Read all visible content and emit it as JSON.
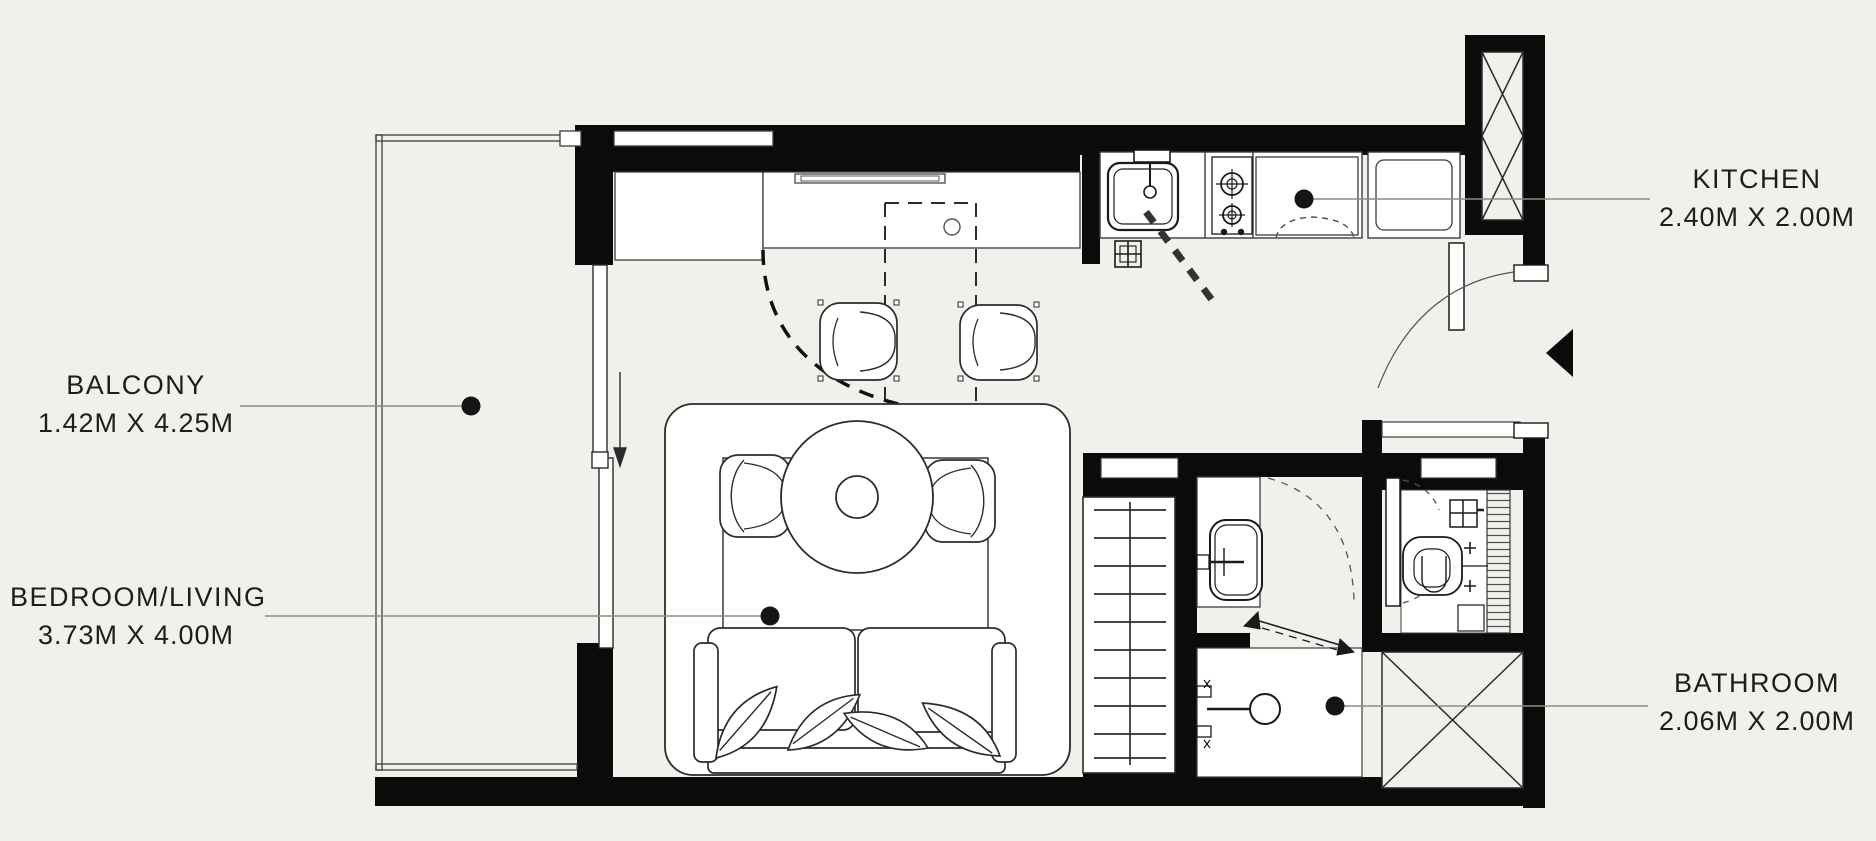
{
  "plan": {
    "title": "Studio apartment floor plan",
    "rooms": {
      "balcony": {
        "label": "BALCONY",
        "dimensions": "1.42M X 4.25M"
      },
      "bedroom_living": {
        "label": "BEDROOM/LIVING",
        "dimensions": "3.73M X 4.00M"
      },
      "kitchen": {
        "label": "KITCHEN",
        "dimensions": "2.40M X 2.00M"
      },
      "bathroom": {
        "label": "BATHROOM",
        "dimensions": "2.06M X 2.00M"
      }
    },
    "fixtures": [
      "kitchen-sink",
      "gas-hob",
      "oven-cabinet",
      "refrigerator",
      "range-hood",
      "floor-drain",
      "breakfast-counter",
      "bar-stool",
      "dining-table",
      "dining-chair",
      "rug",
      "sofa",
      "pillow",
      "wardrobe",
      "sliding-door",
      "entry-door",
      "entry-arrow",
      "vanity-sink",
      "shower",
      "toilet",
      "duct-shaft",
      "window"
    ],
    "colors": {
      "background": "#f2f0eb",
      "wall": "#0b0b0b",
      "furniture_line": "#2b2b2b",
      "leader_line": "#8f8b85",
      "fixture_fill": "#ffffff"
    }
  }
}
